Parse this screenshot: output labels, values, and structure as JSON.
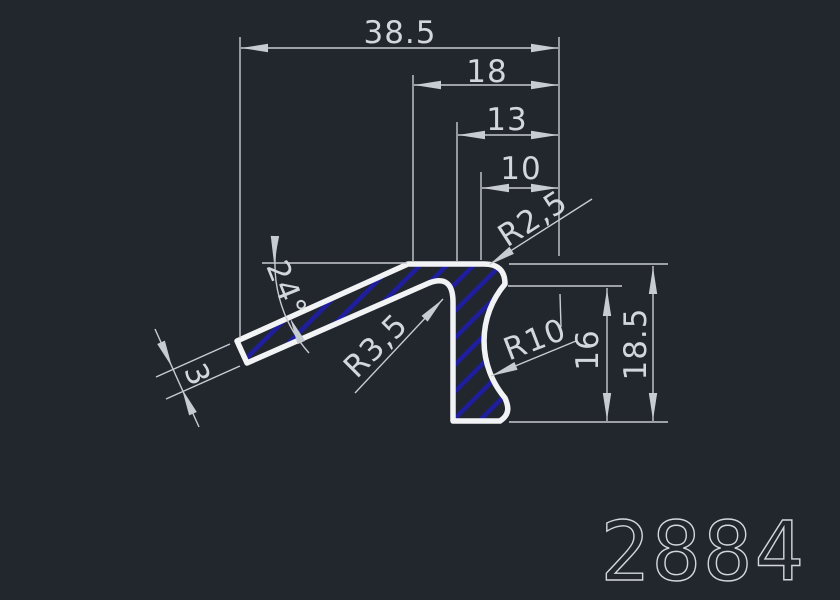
{
  "drawing": {
    "part_number": "2884",
    "dimensions": {
      "overall_width": "38.5",
      "upper_width": "18",
      "mid_width": "13",
      "inner_width": "10",
      "top_corner_radius": "R2,5",
      "arm_angle": "24°",
      "inner_fillet_radius": "R3,5",
      "arm_thickness": "3",
      "side_concave_radius": "R10",
      "inner_height": "16",
      "overall_height": "18.5"
    },
    "colors": {
      "background": "#22262d",
      "profile_outline": "#f2f3f5",
      "dimension_lines": "#c7ccd2",
      "dimension_text": "#d2d7dc",
      "hatch": "#1e1e9e"
    }
  }
}
